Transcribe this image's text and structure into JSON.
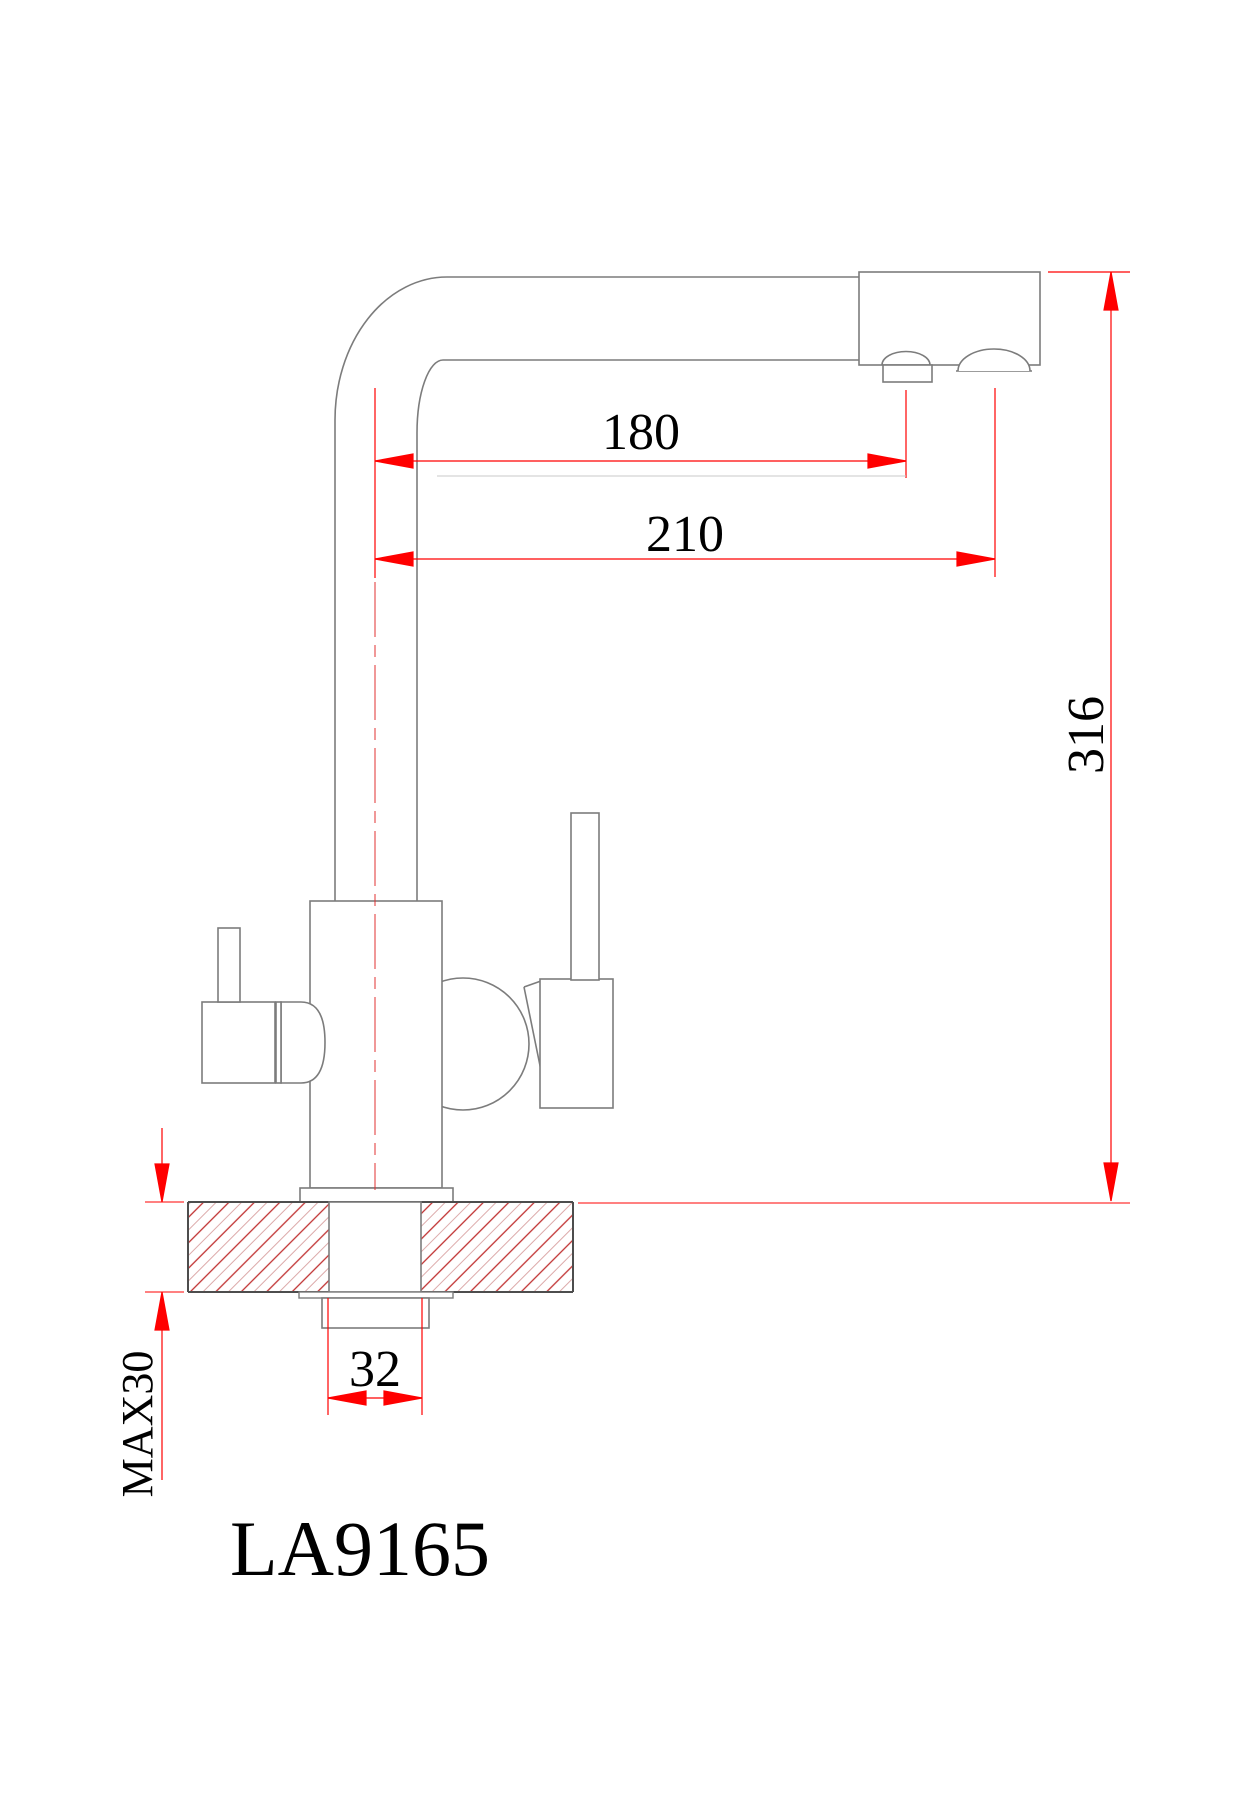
{
  "drawing": {
    "title": "Faucet installation dimension drawing",
    "model_label": "LA9165",
    "dimensions": {
      "spout_reach": "180",
      "total_reach": "210",
      "overall_height": "316",
      "shank_width": "32",
      "counter_thickness_max": "MAX30"
    },
    "colors": {
      "dimension_red": "#ff0000",
      "centerline_red": "#e03030",
      "outline_gray": "#7c7c7c",
      "countertop_dark": "#4d4d4d",
      "hatch_red": "#c03030",
      "hatch_pale": "#dcaaaa",
      "faint_gray": "#c8c8c8",
      "text_black": "#000000",
      "background": "#ffffff"
    }
  }
}
